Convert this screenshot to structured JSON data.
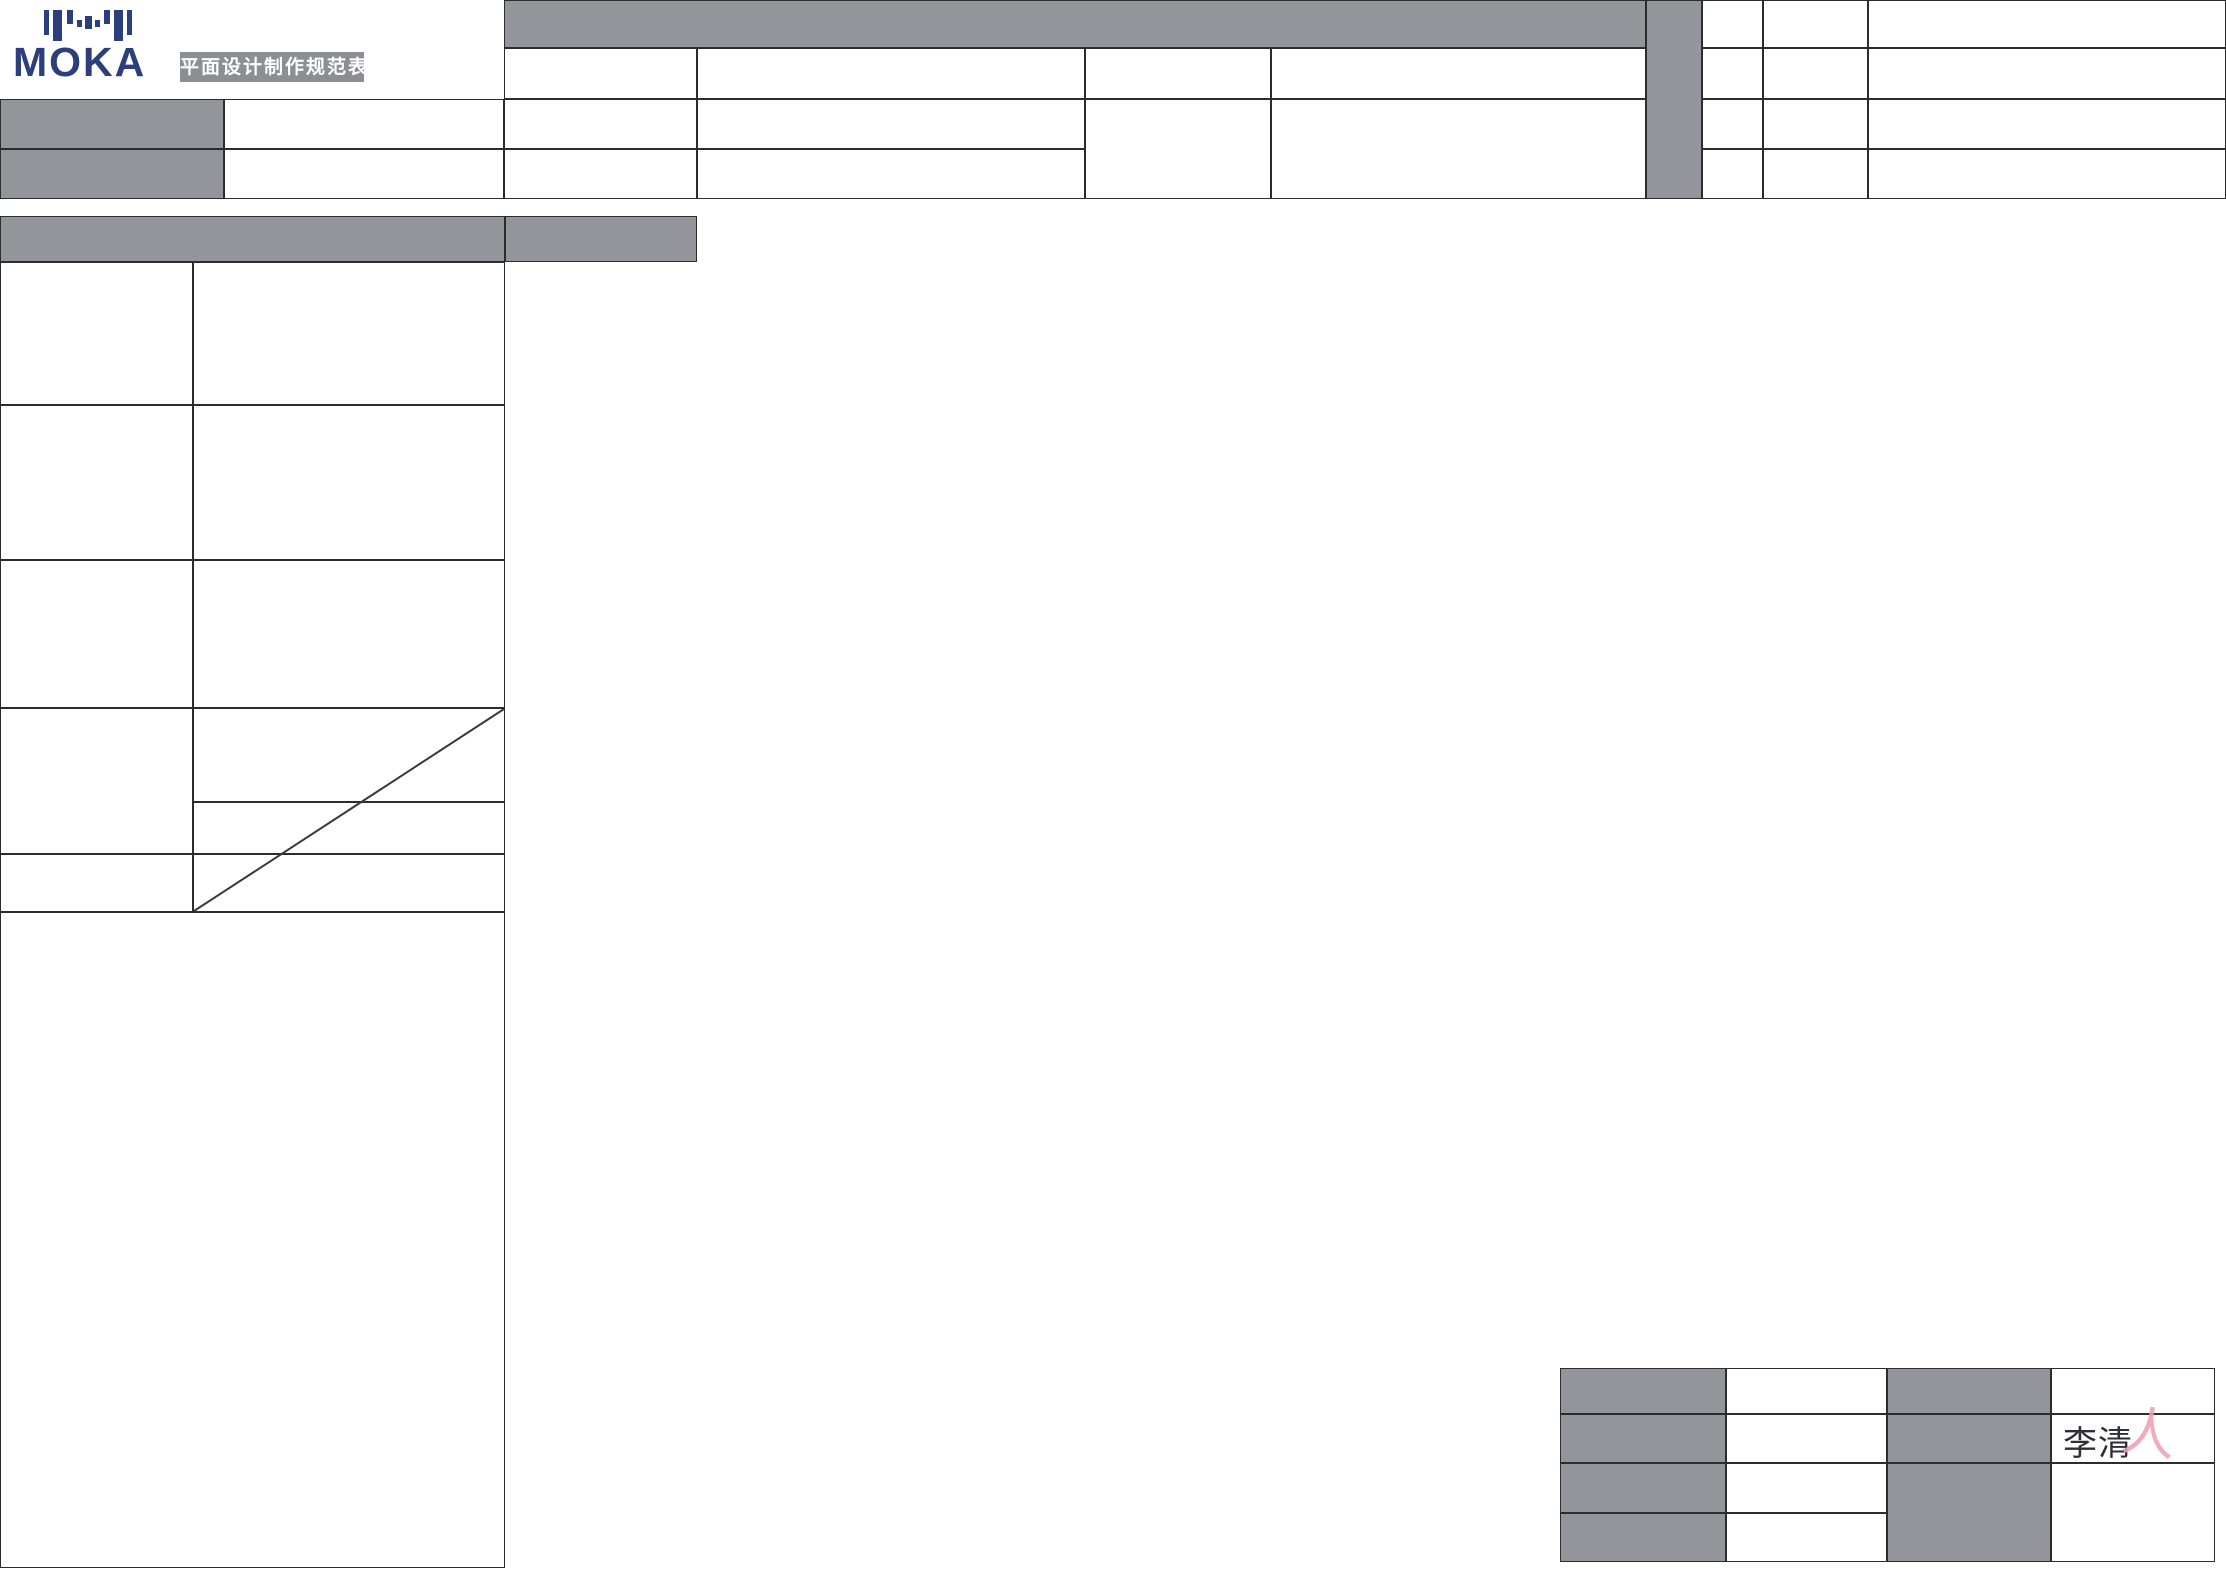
{
  "branding": {
    "logo_text": "MOKA",
    "badge_label": "平面设计制作规范表"
  },
  "signature": {
    "name": "李清",
    "mark": "人"
  },
  "colors": {
    "cell_gray": "#93959a",
    "badge_gray": "#8c8e93",
    "logo_navy": "#2c3e7c",
    "border": "#2c2c2c",
    "signature_ink": "#2e2e36",
    "signature_pink": "#ec9fb0"
  }
}
